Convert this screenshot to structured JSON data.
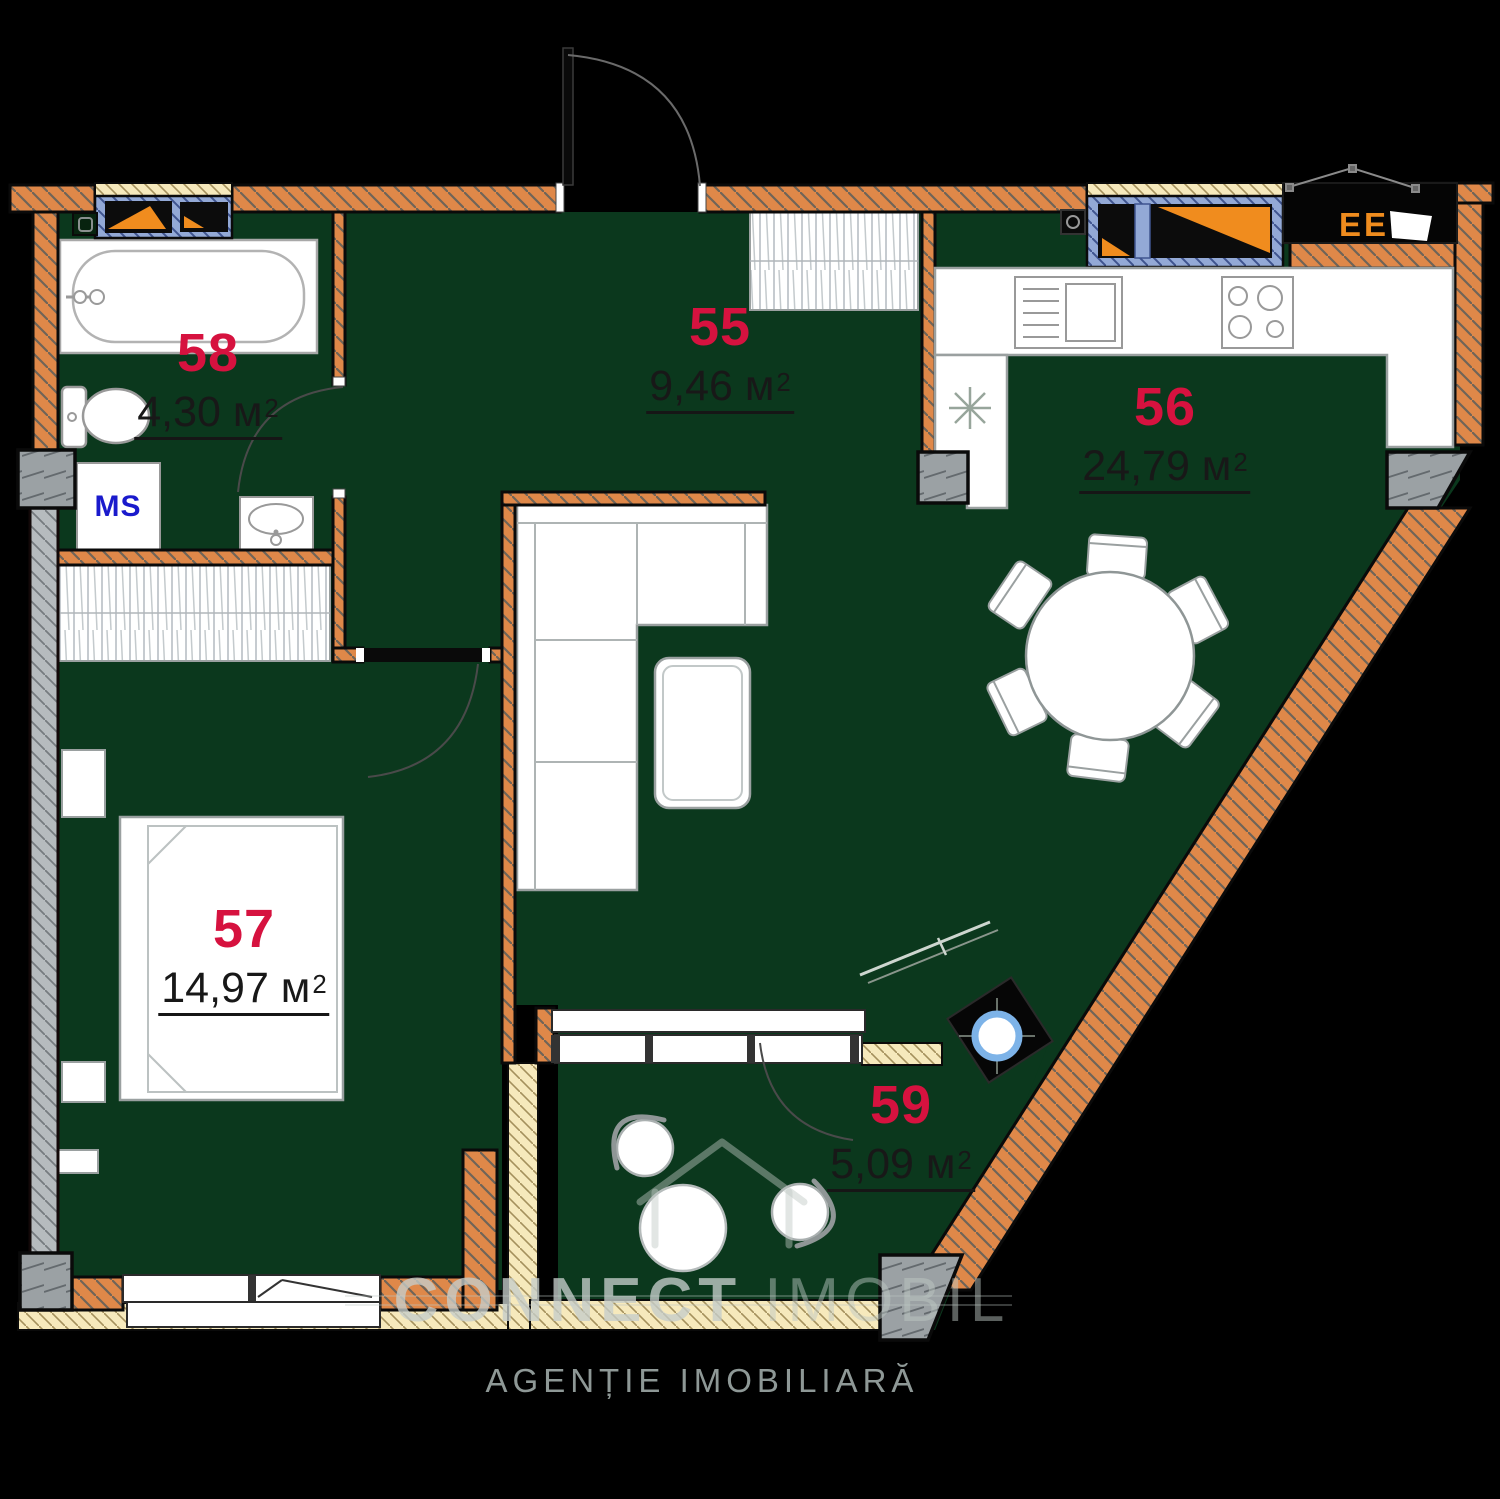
{
  "plan": {
    "type": "apartment-floor-plan",
    "rooms": [
      {
        "number": "55",
        "area": "9,46 м",
        "sup": "2"
      },
      {
        "number": "56",
        "area": "24,79 м",
        "sup": "2"
      },
      {
        "number": "57",
        "area": "14,97 м",
        "sup": "2"
      },
      {
        "number": "58",
        "area": "4,30 м",
        "sup": "2"
      },
      {
        "number": "59",
        "area": "5,09 м",
        "sup": "2"
      }
    ],
    "labels": {
      "ms": "MS",
      "ee": "EE"
    },
    "watermark": {
      "brand_primary": "CONNECT",
      "brand_secondary": "IMOBIL",
      "tagline": "AGENȚIE IMOBILIARĂ"
    },
    "colors": {
      "background": "#000000",
      "floor": "#0b381d",
      "wall": "#df8849",
      "glazing": "#f6e9bc",
      "window_frame": "#93a9d6",
      "column": "#9ba1a4",
      "room_number": "#d6123f",
      "ms_blue": "#1a1acc",
      "ee_orange": "#ef8c1e",
      "ring_blue": "#7db3e8"
    }
  }
}
